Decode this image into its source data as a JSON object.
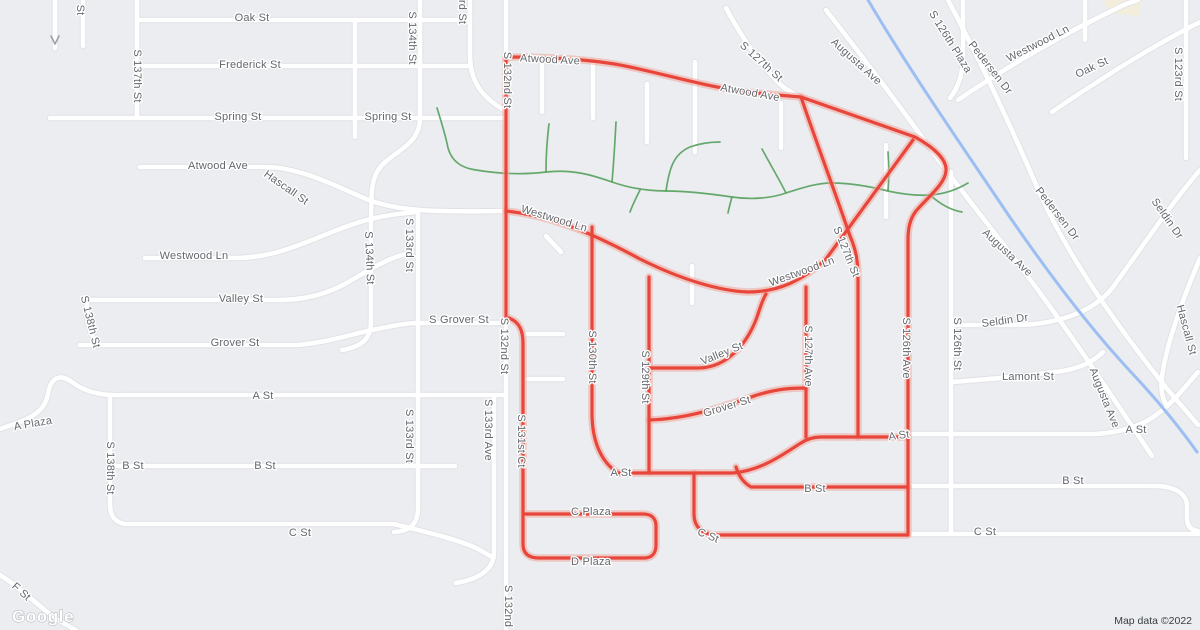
{
  "map": {
    "watermark": "Google",
    "attribution": "Map data ©2022",
    "colors": {
      "land": "#ebedf0",
      "road_fill": "#ffffff",
      "road_casing": "#dfe1e5",
      "route": "#e8463b",
      "route_halo": "#f0a79f",
      "water": "#9dbef2",
      "trail": "#57a05d",
      "label": "#63676c",
      "landmark": "#f3eedb",
      "attribution_text": "#3a3d41"
    },
    "route": {
      "name": "highlighted-route",
      "paths": [
        "M506,57 V318",
        "M506,57 C556,57 598,60 630,67 C668,75 700,85 740,91 C772,95 790,96 801,97 L915,137 C933,147 947,159 946,171 C945,184 928,197 916,211 C910,219 908,228 908,240 V533",
        "M506,211 C552,216 592,233 640,259 C682,280 720,291 748,292 C778,292 802,281 826,259 L913,140",
        "M801,97 C813,133 834,189 850,236 C857,252 858,264 858,279 V437",
        "M592,227 V413 C592,441 601,462 618,473",
        "M649,277 V472",
        "M650,368 H698 C728,368 748,342 757,317 C761,305 763,299 766,294",
        "M806,287 V437",
        "M649,420 C688,419 722,407 757,395 C780,388 795,388 806,388",
        "M618,473 H733 C764,470 786,452 801,443 C807,439 813,437 821,437 H908",
        "M736,467 C739,477 744,483 751,487 H908",
        "M694,473 V514 C694,527 702,534 715,535 H908",
        "M509,318 C519,322 523,330 523,343 V544 C523,553 528,558 539,558 H644 C652,558 656,553 656,545 V526 C656,518 651,514 643,514 H523"
      ]
    },
    "labels": [
      {
        "t": "St",
        "x": 80,
        "y": 10,
        "r": 90
      },
      {
        "t": "Oak St",
        "x": 252,
        "y": 18,
        "r": 0
      },
      {
        "t": "S 137th St",
        "x": 137,
        "y": 76,
        "r": 90
      },
      {
        "t": "Frederick St",
        "x": 250,
        "y": 65,
        "r": 0
      },
      {
        "t": "Spring St",
        "x": 238,
        "y": 117,
        "r": 0
      },
      {
        "t": "Spring St",
        "x": 388,
        "y": 117,
        "r": 0
      },
      {
        "t": "Atwood Ave",
        "x": 218,
        "y": 166,
        "r": 0
      },
      {
        "t": "Hascall St",
        "x": 286,
        "y": 188,
        "r": 35
      },
      {
        "t": "Westwood Ln",
        "x": 194,
        "y": 256,
        "r": 0
      },
      {
        "t": "S 134th St",
        "x": 412,
        "y": 38,
        "r": 90
      },
      {
        "t": "rd St",
        "x": 462,
        "y": 12,
        "r": 90
      },
      {
        "t": "S 134th St",
        "x": 369,
        "y": 258,
        "r": 88
      },
      {
        "t": "Valley St",
        "x": 241,
        "y": 299,
        "r": 0
      },
      {
        "t": "S 138th St",
        "x": 90,
        "y": 322,
        "r": 76
      },
      {
        "t": "Grover St",
        "x": 235,
        "y": 343,
        "r": 0
      },
      {
        "t": "S 133rd St",
        "x": 409,
        "y": 245,
        "r": 90
      },
      {
        "t": "S 133rd St",
        "x": 409,
        "y": 436,
        "r": 90
      },
      {
        "t": "S Grover St",
        "x": 459,
        "y": 320,
        "r": 0
      },
      {
        "t": "S 132nd St",
        "x": 507,
        "y": 80,
        "r": 90
      },
      {
        "t": "S 132nd St",
        "x": 504,
        "y": 346,
        "r": 90
      },
      {
        "t": "S 132nd",
        "x": 508,
        "y": 606,
        "r": 90
      },
      {
        "t": "S 133rd Ave",
        "x": 488,
        "y": 430,
        "r": 90
      },
      {
        "t": "S 131st Ct",
        "x": 521,
        "y": 441,
        "r": 90
      },
      {
        "t": "A Plaza",
        "x": 33,
        "y": 424,
        "r": -10
      },
      {
        "t": "A St",
        "x": 263,
        "y": 396,
        "r": 0
      },
      {
        "t": "S 138th St",
        "x": 110,
        "y": 468,
        "r": 90
      },
      {
        "t": "B St",
        "x": 133,
        "y": 466,
        "r": 0
      },
      {
        "t": "B St",
        "x": 265,
        "y": 466,
        "r": 0
      },
      {
        "t": "C St",
        "x": 300,
        "y": 533,
        "r": 0
      },
      {
        "t": "F St",
        "x": 21,
        "y": 592,
        "r": 42
      },
      {
        "t": "Atwood Ave",
        "x": 550,
        "y": 60,
        "r": 3
      },
      {
        "t": "Atwood Ave",
        "x": 750,
        "y": 93,
        "r": 10
      },
      {
        "t": "S 127th St",
        "x": 761,
        "y": 62,
        "r": 42
      },
      {
        "t": "Westwood Ln",
        "x": 554,
        "y": 219,
        "r": 17
      },
      {
        "t": "Westwood Ln",
        "x": 802,
        "y": 272,
        "r": -20
      },
      {
        "t": "S 127th St",
        "x": 846,
        "y": 252,
        "r": 68
      },
      {
        "t": "S 130th St",
        "x": 592,
        "y": 357,
        "r": 90
      },
      {
        "t": "S 129th St",
        "x": 645,
        "y": 377,
        "r": 90
      },
      {
        "t": "Valley St",
        "x": 722,
        "y": 354,
        "r": -22
      },
      {
        "t": "Grover St",
        "x": 727,
        "y": 407,
        "r": -17
      },
      {
        "t": "S 127th Ave",
        "x": 808,
        "y": 356,
        "r": 90
      },
      {
        "t": "A St",
        "x": 621,
        "y": 473,
        "r": 0
      },
      {
        "t": "A St",
        "x": 899,
        "y": 436,
        "r": -8
      },
      {
        "t": "C Plaza",
        "x": 591,
        "y": 512,
        "r": 0
      },
      {
        "t": "D Plaza",
        "x": 591,
        "y": 562,
        "r": 0
      },
      {
        "t": "C St",
        "x": 708,
        "y": 536,
        "r": 22
      },
      {
        "t": "S 126th Ave",
        "x": 906,
        "y": 348,
        "r": 90
      },
      {
        "t": "B St",
        "x": 815,
        "y": 489,
        "r": 0
      },
      {
        "t": "Augusta Ave",
        "x": 856,
        "y": 62,
        "r": 42
      },
      {
        "t": "S 126th Plaza",
        "x": 950,
        "y": 42,
        "r": 58
      },
      {
        "t": "Pedersen Dr",
        "x": 990,
        "y": 68,
        "r": 52
      },
      {
        "t": "Westwood Ln",
        "x": 1038,
        "y": 44,
        "r": -27
      },
      {
        "t": "Oak St",
        "x": 1092,
        "y": 68,
        "r": -25
      },
      {
        "t": "S 123rd St",
        "x": 1178,
        "y": 74,
        "r": 90
      },
      {
        "t": "Pedersen Dr",
        "x": 1057,
        "y": 214,
        "r": 52
      },
      {
        "t": "Seldin Dr",
        "x": 1167,
        "y": 219,
        "r": 55
      },
      {
        "t": "Augusta Ave",
        "x": 1007,
        "y": 253,
        "r": 43
      },
      {
        "t": "Seldin Dr",
        "x": 1005,
        "y": 321,
        "r": -8
      },
      {
        "t": "S 126th St",
        "x": 957,
        "y": 344,
        "r": 90
      },
      {
        "t": "Hascall St",
        "x": 1186,
        "y": 330,
        "r": 75
      },
      {
        "t": "Lamont St",
        "x": 1028,
        "y": 377,
        "r": 0
      },
      {
        "t": "A St",
        "x": 1136,
        "y": 430,
        "r": 0
      },
      {
        "t": "Augusta Ave",
        "x": 1104,
        "y": 398,
        "r": 68
      },
      {
        "t": "B St",
        "x": 1073,
        "y": 481,
        "r": 0
      },
      {
        "t": "C St",
        "x": 985,
        "y": 532,
        "r": 0
      }
    ]
  }
}
